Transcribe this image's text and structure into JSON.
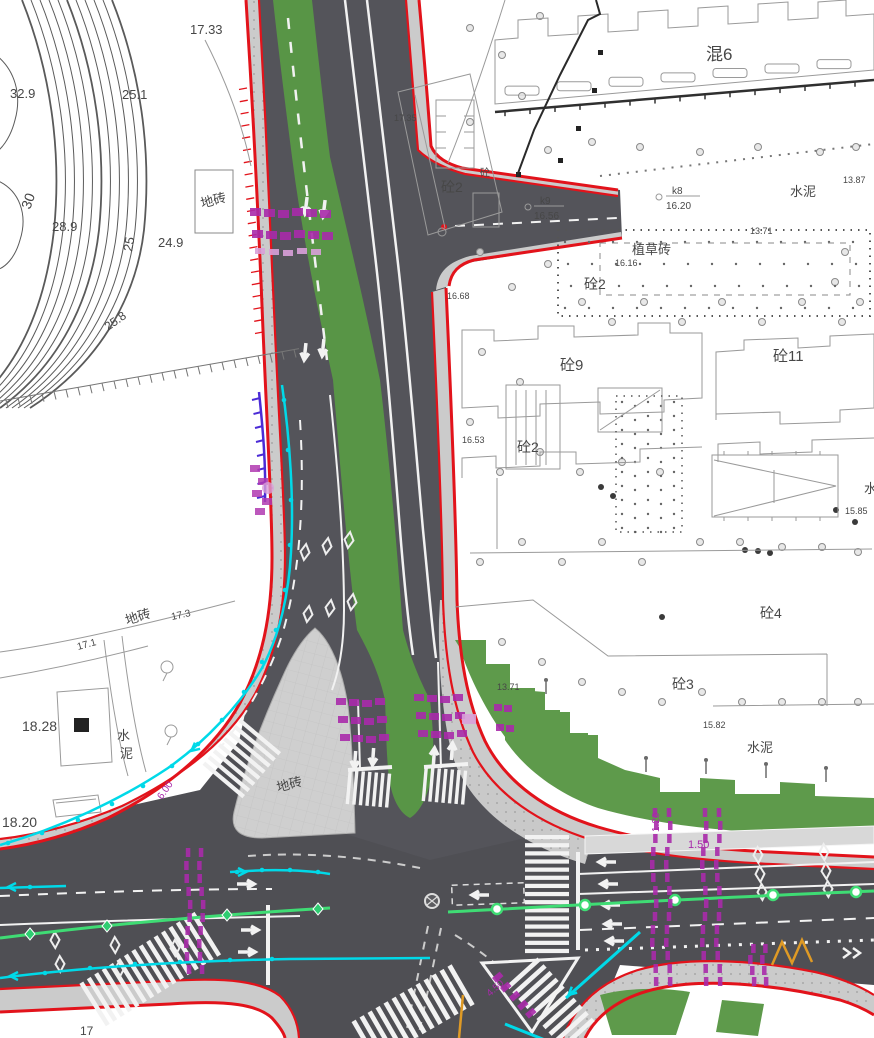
{
  "drawing": {
    "type": "road-intersection-construction-plan",
    "colors": {
      "red": "#e2131b",
      "road": "#54545a",
      "sidewalk": "#cbcbcb",
      "island": "#cfcfcf",
      "green": "#5e9a4b",
      "median": "#589546",
      "cyan": "#00d9e8",
      "node": "#3fdc74",
      "magenta": "#a82aaa",
      "magenta_light": "#d9a0d9",
      "violet": "#4b2bd6",
      "orange": "#df9a25",
      "ink": "#474747",
      "line": "#9a9a9a",
      "mark": "#f2f2f2"
    },
    "labels": [
      {
        "text": "17.33",
        "x": 190,
        "y": 34,
        "s": 13
      },
      {
        "text": "32.9",
        "x": 10,
        "y": 98,
        "s": 13
      },
      {
        "text": "25.1",
        "x": 122,
        "y": 99,
        "s": 13
      },
      {
        "text": "30",
        "x": 30,
        "y": 210,
        "s": 14,
        "r": -70
      },
      {
        "text": "28.9",
        "x": 52,
        "y": 231,
        "s": 13
      },
      {
        "text": "25",
        "x": 132,
        "y": 252,
        "s": 13,
        "r": -80
      },
      {
        "text": "24.9",
        "x": 158,
        "y": 247,
        "s": 13
      },
      {
        "text": "25.8",
        "x": 108,
        "y": 331,
        "s": 12,
        "r": -35
      },
      {
        "text": "地砖",
        "x": 202,
        "y": 208,
        "s": 13,
        "r": -15
      },
      {
        "text": "17.35",
        "x": 394,
        "y": 121,
        "s": 9
      },
      {
        "text": "砼2",
        "x": 441,
        "y": 192,
        "s": 14
      },
      {
        "text": "砼",
        "x": 480,
        "y": 176,
        "s": 10
      },
      {
        "text": "混6",
        "x": 706,
        "y": 60,
        "s": 17
      },
      {
        "text": "k9",
        "x": 540,
        "y": 204,
        "s": 10
      },
      {
        "text": "16.56",
        "x": 534,
        "y": 219,
        "s": 10
      },
      {
        "text": "k8",
        "x": 672,
        "y": 194,
        "s": 10
      },
      {
        "text": "16.20",
        "x": 666,
        "y": 209,
        "s": 10
      },
      {
        "text": "水泥",
        "x": 790,
        "y": 196,
        "s": 13
      },
      {
        "text": "13.87",
        "x": 843,
        "y": 183,
        "s": 9
      },
      {
        "text": "植草砖",
        "x": 632,
        "y": 254,
        "s": 13
      },
      {
        "text": "13.71",
        "x": 750,
        "y": 234,
        "s": 9
      },
      {
        "text": "16.16",
        "x": 615,
        "y": 266,
        "s": 9
      },
      {
        "text": "砼2",
        "x": 584,
        "y": 289,
        "s": 14
      },
      {
        "text": "16.68",
        "x": 447,
        "y": 299,
        "s": 9
      },
      {
        "text": "砼9",
        "x": 560,
        "y": 370,
        "s": 15
      },
      {
        "text": "砼11",
        "x": 773,
        "y": 361,
        "s": 15
      },
      {
        "text": "砼2",
        "x": 517,
        "y": 452,
        "s": 14
      },
      {
        "text": "16.53",
        "x": 462,
        "y": 443,
        "s": 9
      },
      {
        "text": "水",
        "x": 864,
        "y": 493,
        "s": 13
      },
      {
        "text": "15.85",
        "x": 845,
        "y": 514,
        "s": 9
      },
      {
        "text": "砼4",
        "x": 760,
        "y": 618,
        "s": 14
      },
      {
        "text": "砼3",
        "x": 672,
        "y": 689,
        "s": 14
      },
      {
        "text": "13.71",
        "x": 497,
        "y": 690,
        "s": 9
      },
      {
        "text": "15.82",
        "x": 703,
        "y": 728,
        "s": 9
      },
      {
        "text": "水泥",
        "x": 747,
        "y": 752,
        "s": 13
      },
      {
        "text": "地砖",
        "x": 127,
        "y": 625,
        "s": 13,
        "r": -18
      },
      {
        "text": "17.1",
        "x": 78,
        "y": 650,
        "s": 10,
        "r": -15
      },
      {
        "text": "17.3",
        "x": 172,
        "y": 620,
        "s": 10,
        "r": -12
      },
      {
        "text": "18.28",
        "x": 22,
        "y": 731,
        "s": 14
      },
      {
        "text": "水",
        "x": 117,
        "y": 740,
        "s": 13
      },
      {
        "text": "泥",
        "x": 120,
        "y": 758,
        "s": 13
      },
      {
        "text": "18.20",
        "x": 2,
        "y": 827,
        "s": 14
      },
      {
        "text": "17",
        "x": 80,
        "y": 1035,
        "s": 12
      },
      {
        "text": "1.50",
        "x": 688,
        "y": 848,
        "s": 11,
        "c": "magenta"
      },
      {
        "text": "1.20",
        "x": 659,
        "y": 832,
        "s": 10,
        "r": -90,
        "c": "magenta"
      },
      {
        "text": "4.50",
        "x": 490,
        "y": 997,
        "s": 10,
        "r": -42,
        "c": "magenta"
      },
      {
        "text": "6.00",
        "x": 162,
        "y": 800,
        "s": 10,
        "r": -55,
        "c": "magenta"
      },
      {
        "text": "地砖",
        "x": 278,
        "y": 792,
        "s": 13,
        "r": -15
      }
    ]
  }
}
